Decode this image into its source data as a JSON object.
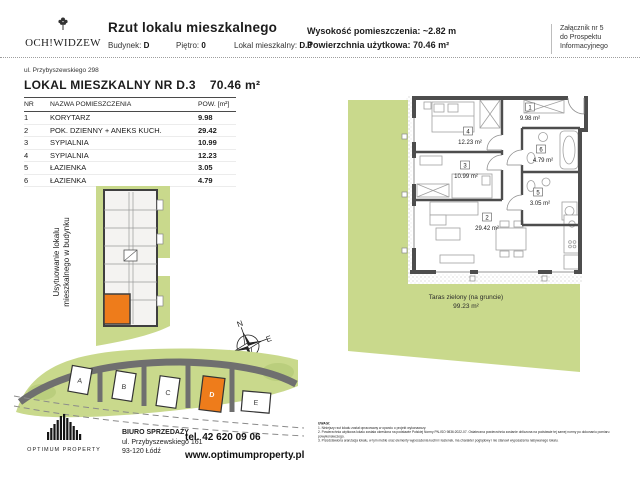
{
  "header": {
    "logo_text": "OCH!WIDZEW",
    "title": "Rzut lokalu mieszkalnego",
    "building_label": "Budynek:",
    "building_value": "D",
    "floor_label": "Piętro:",
    "floor_value": "0",
    "unit_label": "Lokal mieszkalny:",
    "unit_value": "D.3",
    "height_label": "Wysokość pomieszczenia:",
    "height_value": "~2.82 m",
    "usable_area_label": "Powierzchnia użytkowa:",
    "usable_area_value": "70.46 m²",
    "attachment_line1": "Załącznik nr 5",
    "attachment_line2": "do Prospektu",
    "attachment_line3": "Informacyjnego"
  },
  "address": "ul. Przybyszewskiego 298",
  "unit": {
    "title": "LOKAL MIESZKALNY NR D.3",
    "area": "70.46 m²"
  },
  "table": {
    "headers": {
      "nr": "NR",
      "name": "NAZWA POMIESZCZENIA",
      "area": "POW. [m²]"
    },
    "rows": [
      {
        "nr": "1",
        "name": "KORYTARZ",
        "area": "9.98"
      },
      {
        "nr": "2",
        "name": "POK. DZIENNY + ANEKS KUCH.",
        "area": "29.42"
      },
      {
        "nr": "3",
        "name": "SYPIALNIA",
        "area": "10.99"
      },
      {
        "nr": "4",
        "name": "SYPIALNIA",
        "area": "12.23"
      },
      {
        "nr": "5",
        "name": "ŁAZIENKA",
        "area": "3.05"
      },
      {
        "nr": "6",
        "name": "ŁAZIENKA",
        "area": "4.79"
      }
    ]
  },
  "sidebar": {
    "caption_line1": "Usytuowanie lokalu",
    "caption_line2": "mieszkalnego w budynku"
  },
  "plan": {
    "rooms": [
      {
        "number": "1",
        "area": "9.98 m²"
      },
      {
        "number": "2",
        "area": "29.42 m²"
      },
      {
        "number": "3",
        "area": "10.99 m²"
      },
      {
        "number": "4",
        "area": "12.23 m²"
      },
      {
        "number": "5",
        "area": "3.05 m²"
      },
      {
        "number": "6",
        "area": "4.79 m²"
      }
    ],
    "terrace_label": "Taras zielony (na gruncie)",
    "terrace_area": "99.23 m²"
  },
  "compass": {
    "n": "N",
    "e": "E",
    "s": "S",
    "w": "W"
  },
  "site_plan": {
    "buildings": [
      {
        "label": "A"
      },
      {
        "label": "B"
      },
      {
        "label": "C"
      },
      {
        "label": "D"
      },
      {
        "label": "E"
      }
    ]
  },
  "footer": {
    "logo": "OPTIMUM PROPERTY",
    "office_title": "BIURO SPRZEDAŻY",
    "office_address1": "ul. Przybyszewskiego 161",
    "office_address2": "93-120 Łódź",
    "phone": "tel. 42 620 09 06",
    "website": "www.optimumproperty.pl"
  },
  "notes": {
    "title": "UWAGI:",
    "items": [
      "1. Niniejszy rzut lokalu został opracowany w oparciu o projekt wykonawczy.",
      "2. Powierzchnia użytkowa lokalu została określona na podstawie Polskiej Normy PN-ISO 9836:2022-07. Ostateczna powierzchnia zostanie obliczona na podstawie tej samej normy po dokonaniu pomiaru powykonawczego.",
      "3. Przedstawiona aranżacja lokalu, w tym meble oraz elementy wyposażenia kuchni i łazienek, ma charakter poglądowy i nie stanowi wyposażenia nabywanego lokalu."
    ]
  },
  "colors": {
    "terrain_green": "#c9d98c",
    "highlight_orange": "#ee7c1b",
    "wall_gray": "#4d4d4d"
  }
}
